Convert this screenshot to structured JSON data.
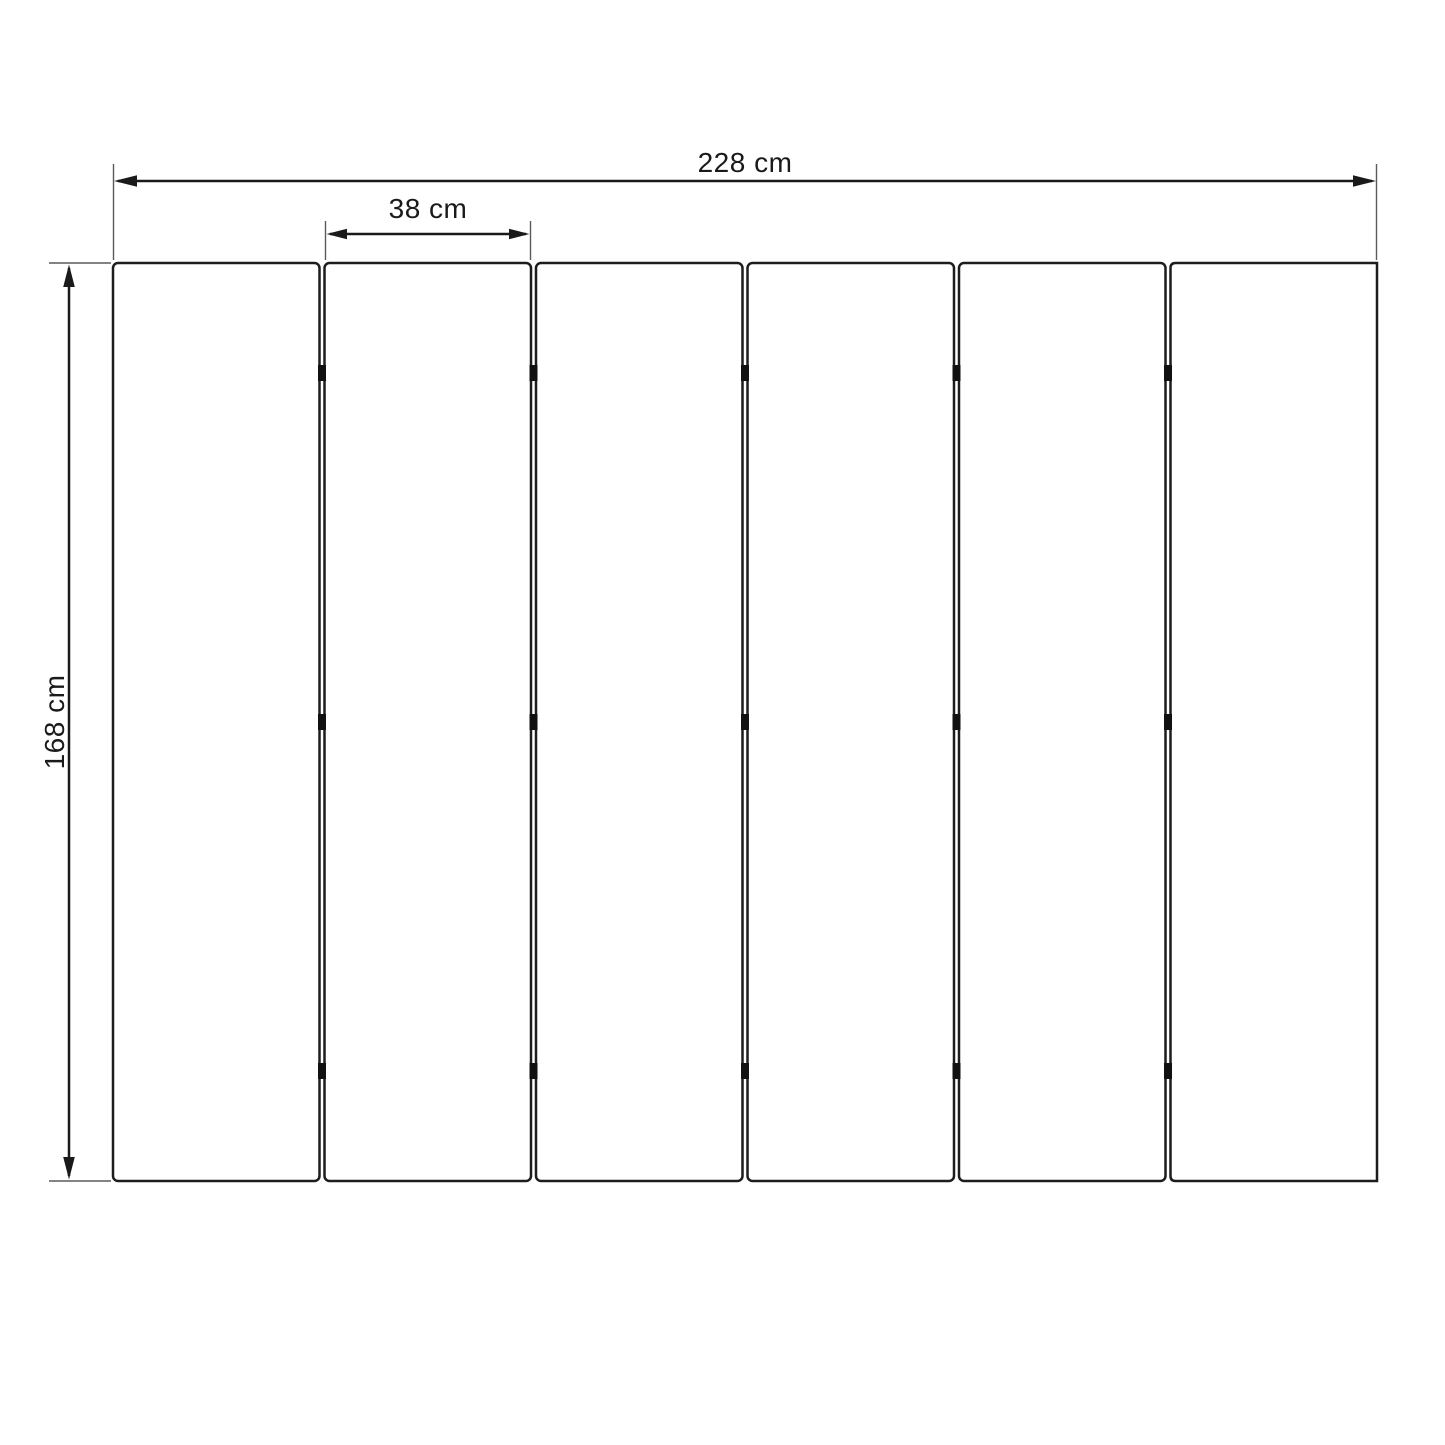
{
  "diagram": {
    "type": "technical-dimension-drawing",
    "subject": "six-panel folding screen / slatted panel set, front elevation",
    "background_color": "#ffffff",
    "line_color": "#1a1a1a",
    "extension_line_color": "#5a5a5a",
    "panel_fill": "#ffffff",
    "panel_count": 6,
    "hinge_rows": 3,
    "hinges_per_gap": 3,
    "dimensions": {
      "total_width": {
        "label": "228 cm",
        "value_cm": 228,
        "applies_to": "overall width of 6 panels"
      },
      "panel_width": {
        "label": "38 cm",
        "value_cm": 38,
        "applies_to": "single panel width"
      },
      "height": {
        "label": "168 cm",
        "value_cm": 168,
        "applies_to": "panel height"
      }
    }
  }
}
